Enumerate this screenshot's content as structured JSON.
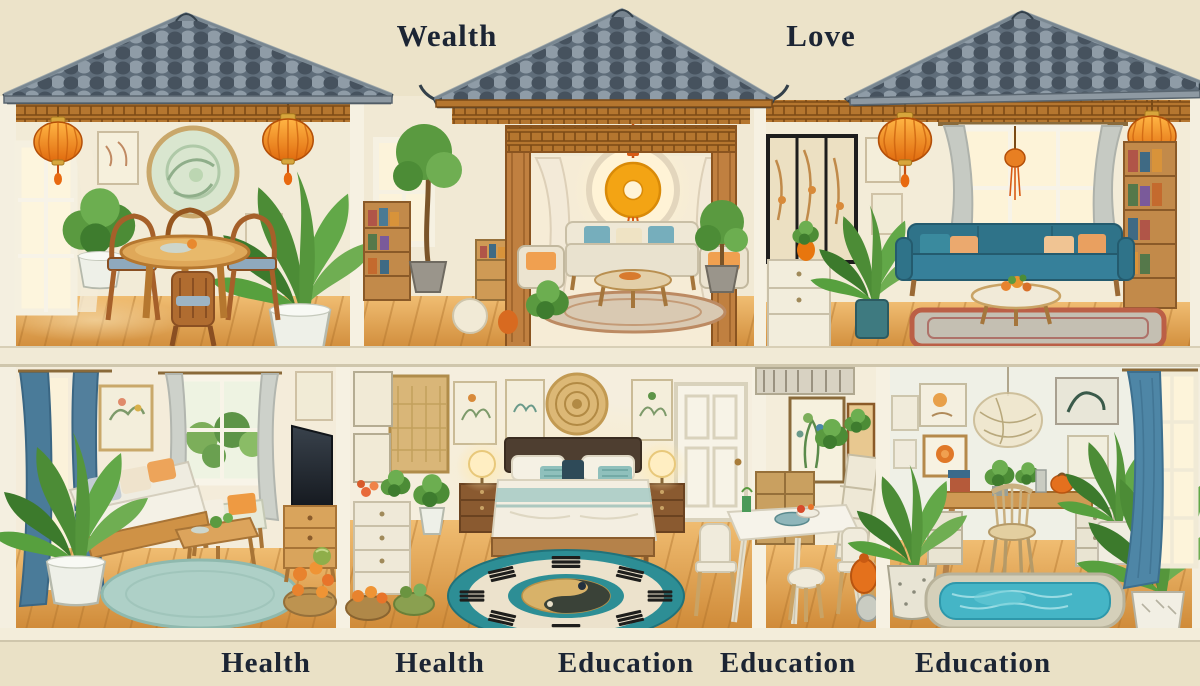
{
  "scene": {
    "title": "Feng shui home cross-section illustration",
    "style": "watercolor dollhouse cutaway, two floors, tiled Chinese roofs"
  },
  "labels": {
    "top": [
      "Wealth",
      "Love"
    ],
    "bottom": [
      "Health",
      "Health",
      "Education",
      "Education",
      "Education"
    ]
  },
  "colors": {
    "background": "#ece3c9",
    "roof_tile": "#5f6d7a",
    "label_text": "#1c2534",
    "lantern_orange": "#ef8418",
    "wood_floor": "#dda253",
    "teal_sofa": "#36809a",
    "bagua_teal": "#2d8e95",
    "pool_water": "#45b5c6",
    "curtain_blue": "#4a7b99",
    "coin_gold": "#f3a414"
  },
  "rooms": {
    "upper": [
      "dining-room",
      "coin-window-pavilion",
      "teal-sofa-living-room"
    ],
    "lower": [
      "cream-sofa-living-room",
      "bedroom-with-bagua-rug",
      "white-dining-nook",
      "study-with-pool-rug"
    ]
  }
}
